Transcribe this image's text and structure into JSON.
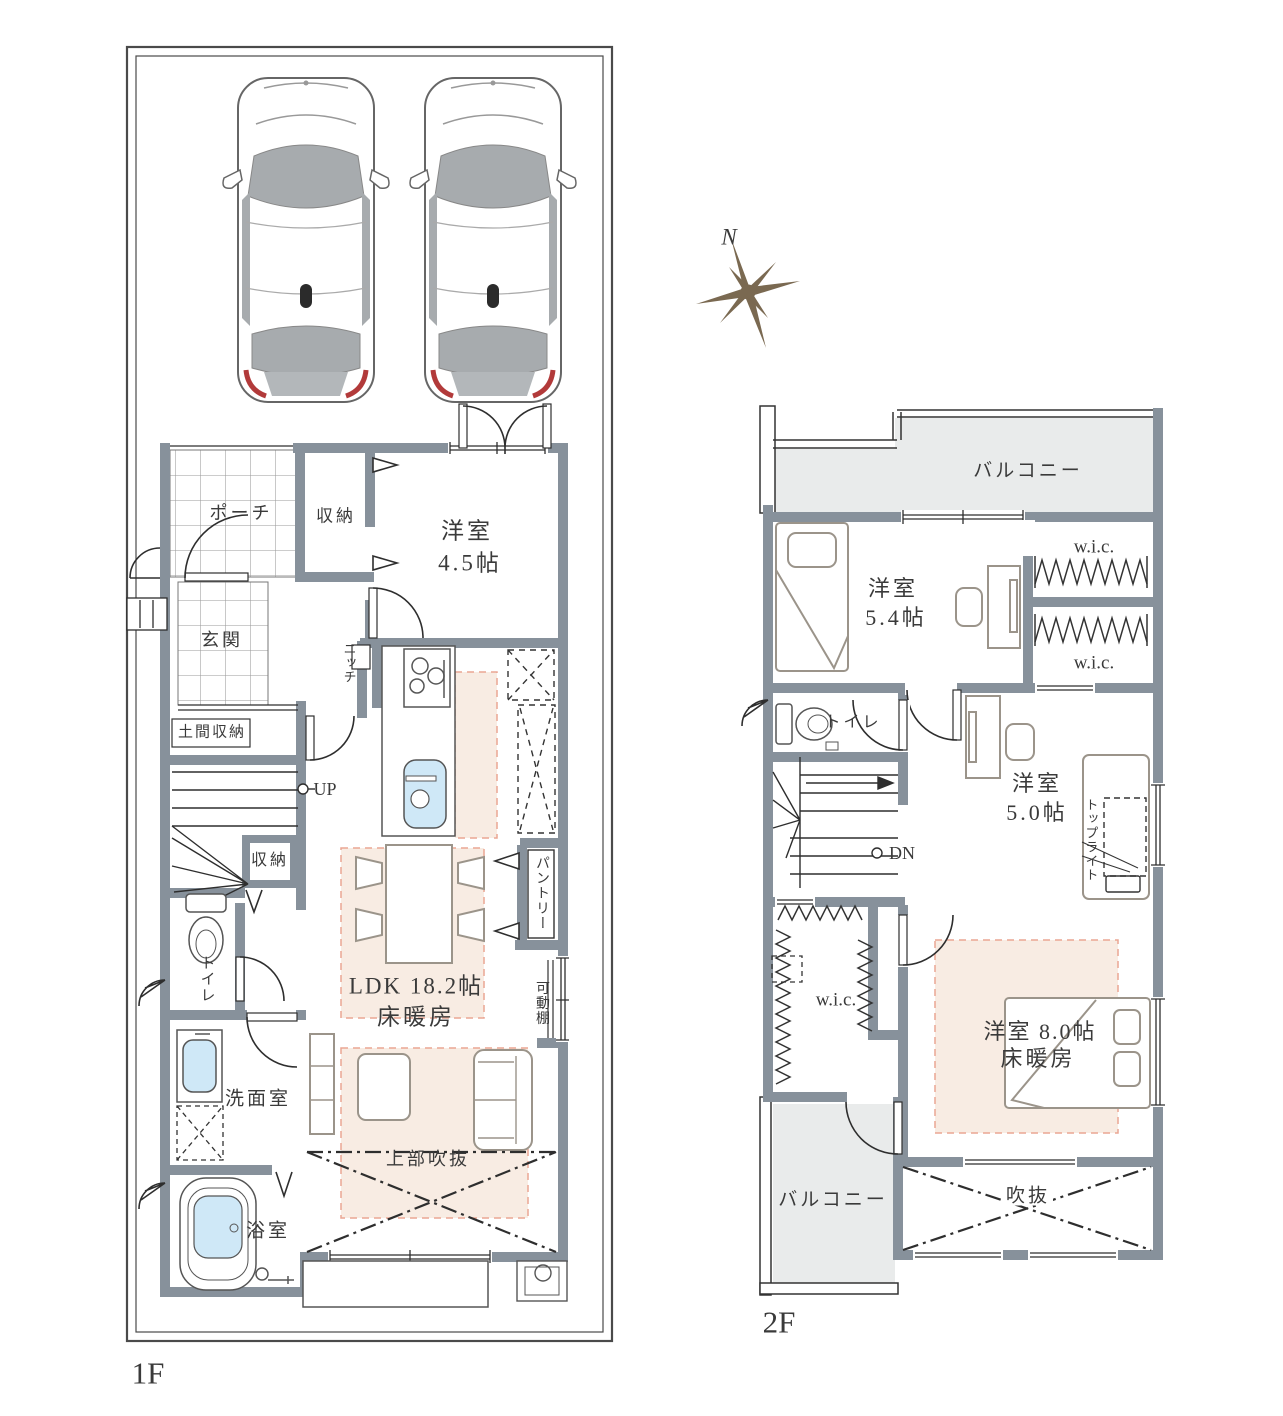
{
  "compass": {
    "north_label": "N"
  },
  "floor1": {
    "floor_label": "1F",
    "rooms": {
      "porch": "ポーチ",
      "entry_closet": "収納",
      "bedroom_name": "洋室",
      "bedroom_size": "4.5帖",
      "entrance": "玄関",
      "niche": "ニッチ",
      "doma_storage": "土間収納",
      "stairs_up": "UP",
      "stair_closet": "収納",
      "toilet": "トイレ",
      "ldk_title": "LDK 18.2帖",
      "ldk_sub": "床暖房",
      "pantry": "パントリー",
      "movable_shelf": "可動棚",
      "washroom": "洗面室",
      "bathroom": "浴室",
      "void_above": "上部吹抜"
    }
  },
  "floor2": {
    "floor_label": "2F",
    "rooms": {
      "balcony_north": "バルコニー",
      "bedroom_a_name": "洋室",
      "bedroom_a_size": "5.4帖",
      "wic_a": "w.i.c.",
      "wic_b": "w.i.c.",
      "toilet": "トイレ",
      "stairs_down": "DN",
      "bedroom_b_name": "洋室",
      "bedroom_b_size": "5.0帖",
      "toplight": "トップライト",
      "wic_c": "w.i.c.",
      "bedroom_c_title": "洋室 8.0帖",
      "bedroom_c_sub": "床暖房",
      "balcony_south": "バルコニー",
      "void": "吹抜"
    }
  },
  "colors": {
    "wall": "#87919b",
    "floor_heating_fill": "#f8ece3",
    "floor_heating_stroke": "#eaa693",
    "water_fixture": "#cfe8f7",
    "balcony_fill": "#e9ebeb",
    "compass": "#7a6951",
    "line": "#2e2e2e"
  }
}
